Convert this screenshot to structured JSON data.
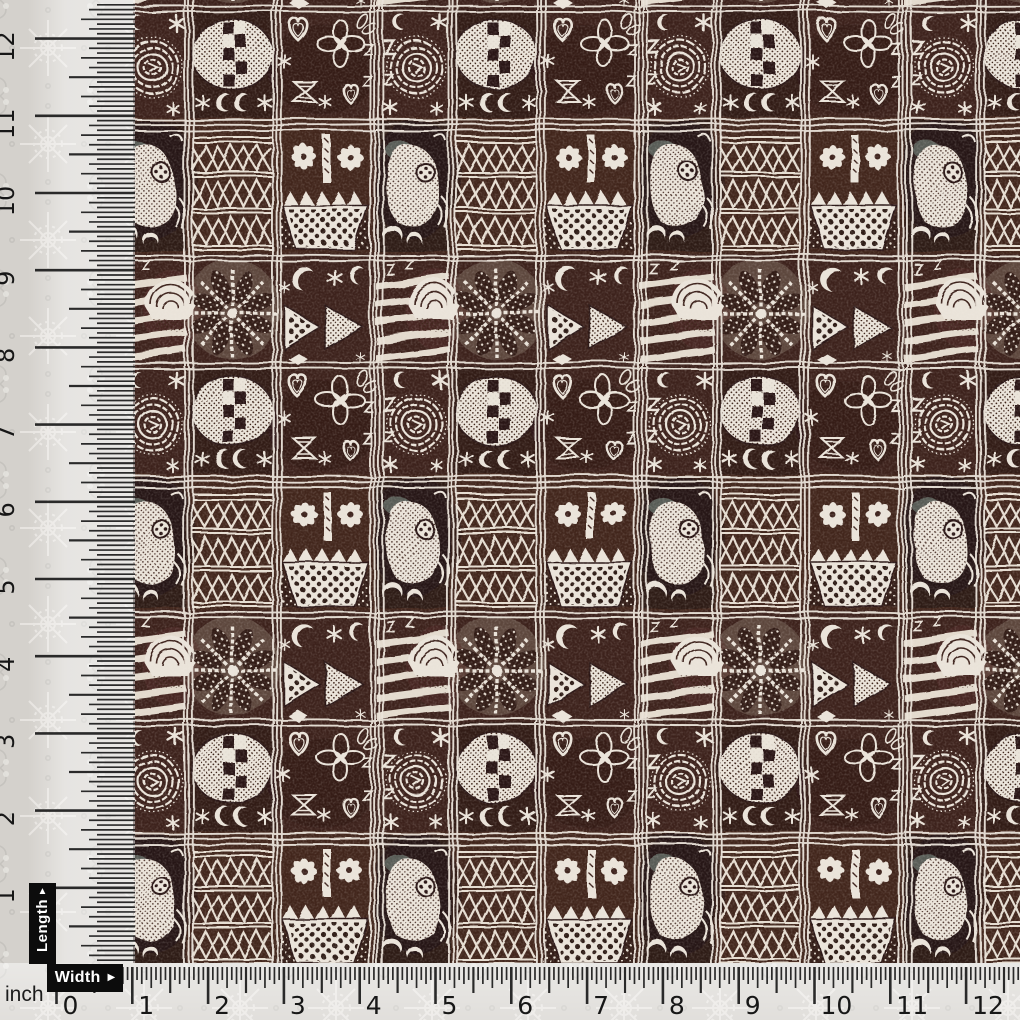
{
  "image": {
    "kind": "product photo of printed fabric with measuring rulers",
    "fabric_style": "African tribal / tapa block print seamless pattern",
    "swatch_span_inches": {
      "width": "about 1 to 12.5",
      "length": "about 0 to 12.5"
    }
  },
  "labels": {
    "length": {
      "text": "Length",
      "arrow": "▲"
    },
    "width": {
      "text": "Width",
      "arrow": "▶"
    },
    "unit_label": "inch"
  },
  "rulers": {
    "unit": "inch",
    "vertical": {
      "numbers": [
        "0",
        "1",
        "2",
        "3",
        "4",
        "5",
        "6",
        "7",
        "8",
        "9",
        "10",
        "11",
        "12"
      ]
    },
    "horizontal": {
      "numbers": [
        "0",
        "1",
        "2",
        "3",
        "4",
        "5",
        "6",
        "7",
        "8",
        "9",
        "10",
        "11",
        "12"
      ]
    }
  },
  "colors": {
    "fabric_dark_brown": "#3c221c",
    "fabric_deep_brown": "#261513",
    "fabric_rust": "#4e2d24",
    "motif_cream": "#eae3d9",
    "teal_accent": "#7f948c",
    "background_grey": "#d4d1cc",
    "ruler_ink": "#1b1b1b",
    "label_box": "#0c0c0c",
    "label_text": "#ffffff"
  },
  "fabric_motifs": [
    "concentric spiral with Z and N marks",
    "dotted oval with checkerboard squares",
    "crescent moons and asterisk stars",
    "quatrefoil flower with double outline",
    "hearts and butterfly bow-ties",
    "fish with four-dot eye",
    "triangle lattice bands",
    "eight-petal daisies over polka-dot basket with zigzag rim",
    "diagonal stripe bands with shell fan",
    "eight-spoke starburst palm with dotted wedges",
    "polka-dot and hatched arrow chevron",
    "white double grid lines between blocks"
  ]
}
